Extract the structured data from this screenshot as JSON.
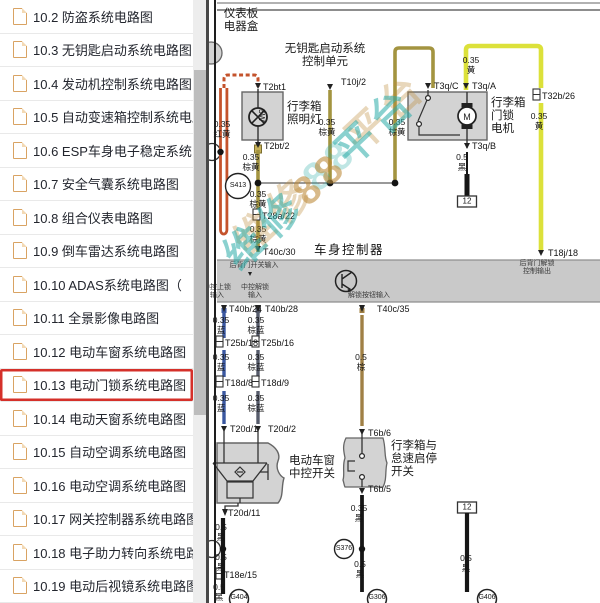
{
  "sidebar": {
    "items": [
      {
        "label": "10.2 防盗系统电路图",
        "selected": false
      },
      {
        "label": "10.3 无钥匙启动系统电路图",
        "selected": false
      },
      {
        "label": "10.4 发动机控制系统电路图",
        "selected": false
      },
      {
        "label": "10.5 自动变速箱控制系统电路图",
        "selected": false
      },
      {
        "label": "10.6 ESP车身电子稳定系统电路图",
        "selected": false
      },
      {
        "label": "10.7 安全气囊系统电路图",
        "selected": false
      },
      {
        "label": "10.8 组合仪表电路图",
        "selected": false
      },
      {
        "label": "10.9 倒车雷达系统电路图",
        "selected": false
      },
      {
        "label": "10.10 ADAS系统电路图（",
        "selected": false
      },
      {
        "label": "10.11 全景影像电路图",
        "selected": false
      },
      {
        "label": "10.12 电动车窗系统电路图",
        "selected": false
      },
      {
        "label": "10.13 电动门锁系统电路图",
        "selected": true
      },
      {
        "label": "10.14 电动天窗系统电路图",
        "selected": false
      },
      {
        "label": "10.15 自动空调系统电路图",
        "selected": false
      },
      {
        "label": "10.16 电动空调系统电路图",
        "selected": false
      },
      {
        "label": "10.17 网关控制器系统电路图",
        "selected": false
      },
      {
        "label": "10.18 电子助力转向系统电路图",
        "selected": false
      },
      {
        "label": "10.19 电动后视镜系统电路图",
        "selected": false
      }
    ]
  },
  "watermark": {
    "part1": "维修",
    "part2": "88",
    "part3": "平台"
  },
  "diagram": {
    "colors": {
      "yellow": "#dce13a",
      "olive": "#a39440",
      "red": "#c4532c",
      "blue": "#3a57a0",
      "brown_blue": "#565b6b",
      "brown": "#a08045",
      "black": "#161616",
      "box_fill": "#d3d3d3",
      "band_fill": "#c9c9c9",
      "highlight": "#d5302a"
    },
    "labels": [
      {
        "t": "仪表板\n电器盒",
        "x": 241,
        "y": 8,
        "c": "comp ctr"
      },
      {
        "t": "无钥匙启动系统\n控制单元",
        "x": 325,
        "y": 43,
        "c": "comp ctr"
      },
      {
        "t": "行李箱\n照明灯",
        "x": 287,
        "y": 101,
        "c": "comp"
      },
      {
        "t": "行李箱\n门锁\n电机",
        "x": 491,
        "y": 97,
        "c": "comp"
      },
      {
        "t": "车身控制器",
        "x": 349,
        "y": 243,
        "c": "bctrl ctr"
      },
      {
        "t": "电动车窗\n中控开关",
        "x": 312,
        "y": 455,
        "c": "comp ctr"
      },
      {
        "t": "行李箱与\n怠速启停\n开关",
        "x": 391,
        "y": 440,
        "c": "comp"
      },
      {
        "t": "5W",
        "x": 266,
        "y": 109,
        "c": "rot"
      },
      {
        "t": "T10j/2",
        "x": 341,
        "y": 77,
        "c": "pin"
      },
      {
        "t": "T2bt1",
        "x": 263,
        "y": 82,
        "c": "pin"
      },
      {
        "t": "T2bt/2",
        "x": 264,
        "y": 141,
        "c": "pin"
      },
      {
        "t": "T28a/22",
        "x": 262,
        "y": 211,
        "c": "pin"
      },
      {
        "t": "T40c/30",
        "x": 263,
        "y": 247,
        "c": "pin"
      },
      {
        "t": "T3q/C",
        "x": 434,
        "y": 81,
        "c": "pin"
      },
      {
        "t": "T3q/A",
        "x": 472,
        "y": 81,
        "c": "pin"
      },
      {
        "t": "T3q/B",
        "x": 472,
        "y": 141,
        "c": "pin"
      },
      {
        "t": "T32b/26",
        "x": 542,
        "y": 91,
        "c": "pin"
      },
      {
        "t": "T18j/18",
        "x": 548,
        "y": 248,
        "c": "pin"
      },
      {
        "t": "T40b/24",
        "x": 229,
        "y": 304,
        "c": "pin"
      },
      {
        "t": "T40b/28",
        "x": 265,
        "y": 304,
        "c": "pin"
      },
      {
        "t": "T40c/35",
        "x": 377,
        "y": 304,
        "c": "pin"
      },
      {
        "t": "T25b/18",
        "x": 225,
        "y": 338,
        "c": "pin"
      },
      {
        "t": "T25b/16",
        "x": 261,
        "y": 338,
        "c": "pin"
      },
      {
        "t": "T18d/8",
        "x": 225,
        "y": 378,
        "c": "pin"
      },
      {
        "t": "T18d/9",
        "x": 261,
        "y": 378,
        "c": "pin"
      },
      {
        "t": "T20d/1",
        "x": 230,
        "y": 424,
        "c": "pin"
      },
      {
        "t": "T20d/2",
        "x": 268,
        "y": 424,
        "c": "pin"
      },
      {
        "t": "T20d/11",
        "x": 228,
        "y": 508,
        "c": "pin"
      },
      {
        "t": "T6b/6",
        "x": 368,
        "y": 428,
        "c": "pin"
      },
      {
        "t": "T6b/5",
        "x": 368,
        "y": 484,
        "c": "pin"
      },
      {
        "t": "T18e/15",
        "x": 224,
        "y": 570,
        "c": "pin"
      },
      {
        "t": "0.35\n红黄",
        "x": 222,
        "y": 120,
        "c": "wire ctr"
      },
      {
        "t": "0.35\n棕黄",
        "x": 327,
        "y": 118,
        "c": "wire ctr"
      },
      {
        "t": "0.35\n棕黄",
        "x": 397,
        "y": 118,
        "c": "wire ctr"
      },
      {
        "t": "0.35\n棕黄",
        "x": 251,
        "y": 153,
        "c": "wire ctr"
      },
      {
        "t": "0.35\n棕黄",
        "x": 258,
        "y": 190,
        "c": "wire ctr"
      },
      {
        "t": "0.35\n棕黄",
        "x": 258,
        "y": 225,
        "c": "wire ctr"
      },
      {
        "t": "0.35\n黄",
        "x": 471,
        "y": 56,
        "c": "wire ctr"
      },
      {
        "t": "0.35\n黄",
        "x": 539,
        "y": 112,
        "c": "wire ctr"
      },
      {
        "t": "0.5\n黑",
        "x": 462,
        "y": 153,
        "c": "wire ctr"
      },
      {
        "t": "0.35\n蓝",
        "x": 221,
        "y": 316,
        "c": "wire ctr"
      },
      {
        "t": "0.35\n棕蓝",
        "x": 256,
        "y": 316,
        "c": "wire ctr"
      },
      {
        "t": "0.35\n蓝",
        "x": 221,
        "y": 353,
        "c": "wire ctr"
      },
      {
        "t": "0.35\n棕蓝",
        "x": 256,
        "y": 353,
        "c": "wire ctr"
      },
      {
        "t": "0.5\n棕",
        "x": 361,
        "y": 353,
        "c": "wire ctr"
      },
      {
        "t": "0.35\n蓝",
        "x": 221,
        "y": 394,
        "c": "wire ctr"
      },
      {
        "t": "0.35\n棕蓝",
        "x": 256,
        "y": 394,
        "c": "wire ctr"
      },
      {
        "t": "0.5\n黑",
        "x": 221,
        "y": 523,
        "c": "wire ctr"
      },
      {
        "t": "0.5\n黑",
        "x": 221,
        "y": 553,
        "c": "wire ctr"
      },
      {
        "t": "0.5\n黑",
        "x": 219,
        "y": 583,
        "c": "wire ctr"
      },
      {
        "t": "0.35\n黑",
        "x": 359,
        "y": 504,
        "c": "wire ctr"
      },
      {
        "t": "0.5\n黑",
        "x": 360,
        "y": 560,
        "c": "wire ctr"
      },
      {
        "t": "0.5\n黑",
        "x": 466,
        "y": 554,
        "c": "wire ctr"
      },
      {
        "t": "后背门开关输入",
        "x": 254,
        "y": 262,
        "c": "tiny ctr"
      },
      {
        "t": "中控上锁\n输入",
        "x": 217,
        "y": 284,
        "c": "tiny ctr"
      },
      {
        "t": "中控解锁\n输入",
        "x": 255,
        "y": 284,
        "c": "tiny ctr"
      },
      {
        "t": "解锁按钮输入",
        "x": 369,
        "y": 292,
        "c": "tiny ctr"
      },
      {
        "t": "后背门解锁\n控制输出",
        "x": 537,
        "y": 260,
        "c": "tiny ctr"
      },
      {
        "t": "S413",
        "x": 238,
        "y": 186,
        "c": "splice"
      },
      {
        "t": "S376",
        "x": 344,
        "y": 549,
        "c": "splice"
      },
      {
        "t": "G404",
        "x": 239,
        "y": 594,
        "c": "gname"
      },
      {
        "t": "G306",
        "x": 377,
        "y": 594,
        "c": "gname"
      },
      {
        "t": "G406",
        "x": 487,
        "y": 594,
        "c": "gname"
      },
      {
        "t": "12",
        "x": 467,
        "y": 201,
        "c": "g12"
      },
      {
        "t": "12",
        "x": 467,
        "y": 507,
        "c": "g12"
      }
    ]
  }
}
